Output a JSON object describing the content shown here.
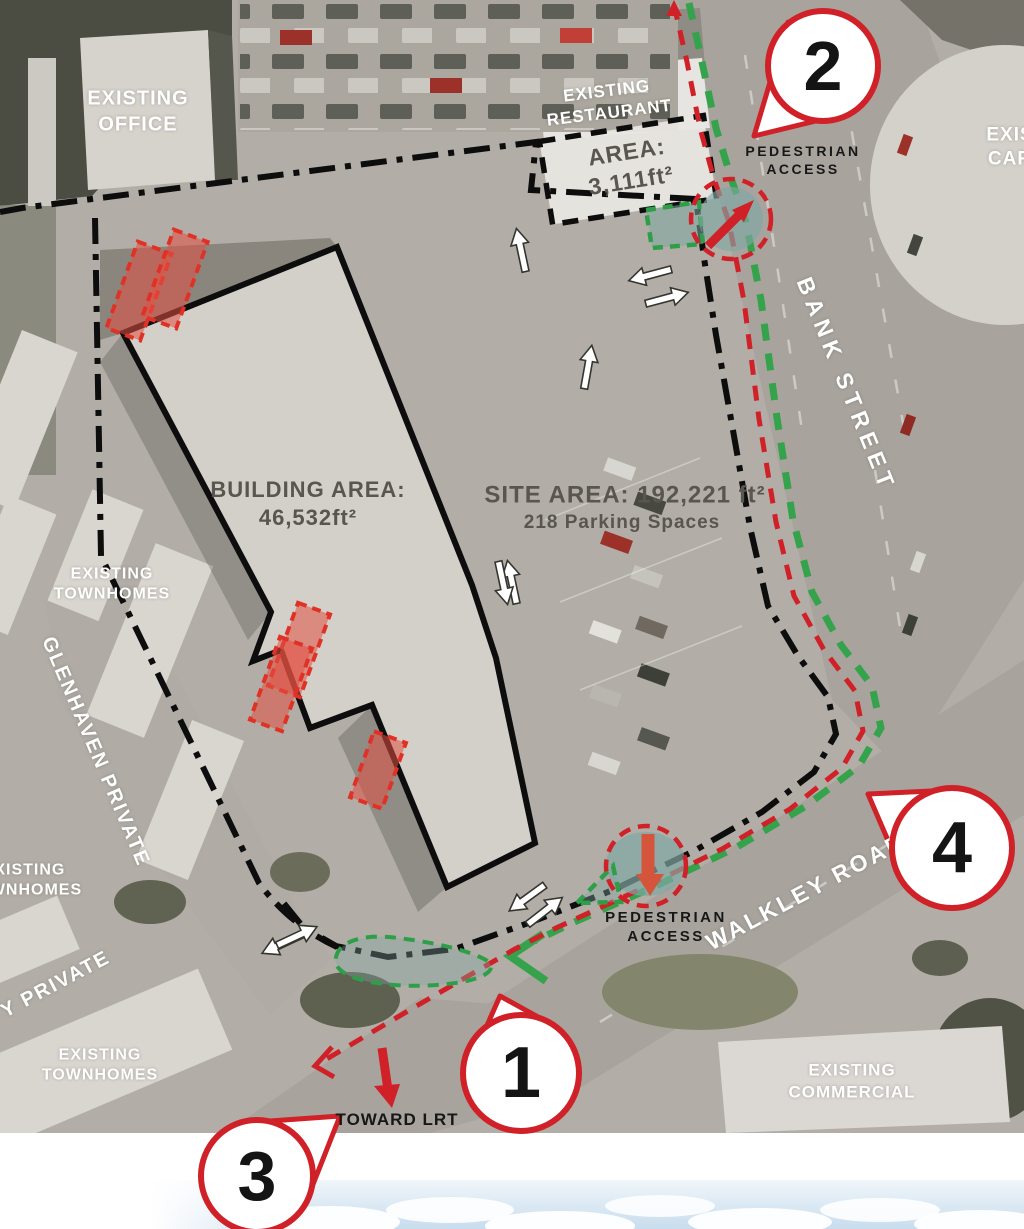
{
  "colors": {
    "accent_red": "#cf2127",
    "route_green": "#35a24c",
    "teal_area": "#80a7a3",
    "text_dark": "#59554f",
    "text_white": "#ffffff"
  },
  "labels": {
    "existing_office": "EXISTING\nOFFICE",
    "existing_restaurant": "EXISTING\nRESTAURANT",
    "restaurant_area": "AREA:\n3,111ft²",
    "pedestrian_access_top": "PEDESTRIAN\nACCESS",
    "pedestrian_access_bottom": "PEDESTRIAN\nACCESS",
    "bank_street": "BANK STREET",
    "walkley_road": "WALKLEY ROAD",
    "glenhaven_private": "GLENHAVEN PRIVATE",
    "y_private": "Y PRIVATE",
    "building_area": "BUILDING AREA:\n46,532ft²",
    "site_area": "SITE AREA: 192,221 ft²",
    "parking_spaces": "218 Parking Spaces",
    "townhomes_upper": "EXISTING\nTOWNHOMES",
    "townhomes_mid": "EXISTING\nTOWNHOMES",
    "townhomes_lower": "EXISTING\nTOWNHOMES",
    "existing_commercial": "EXISTING\nCOMMERCIAL",
    "existing_car_partial": "EXIS\nCAR",
    "toward_lrt": "TOWARD LRT"
  },
  "callouts": {
    "c1": "1",
    "c2": "2",
    "c3": "3",
    "c4": "4"
  }
}
